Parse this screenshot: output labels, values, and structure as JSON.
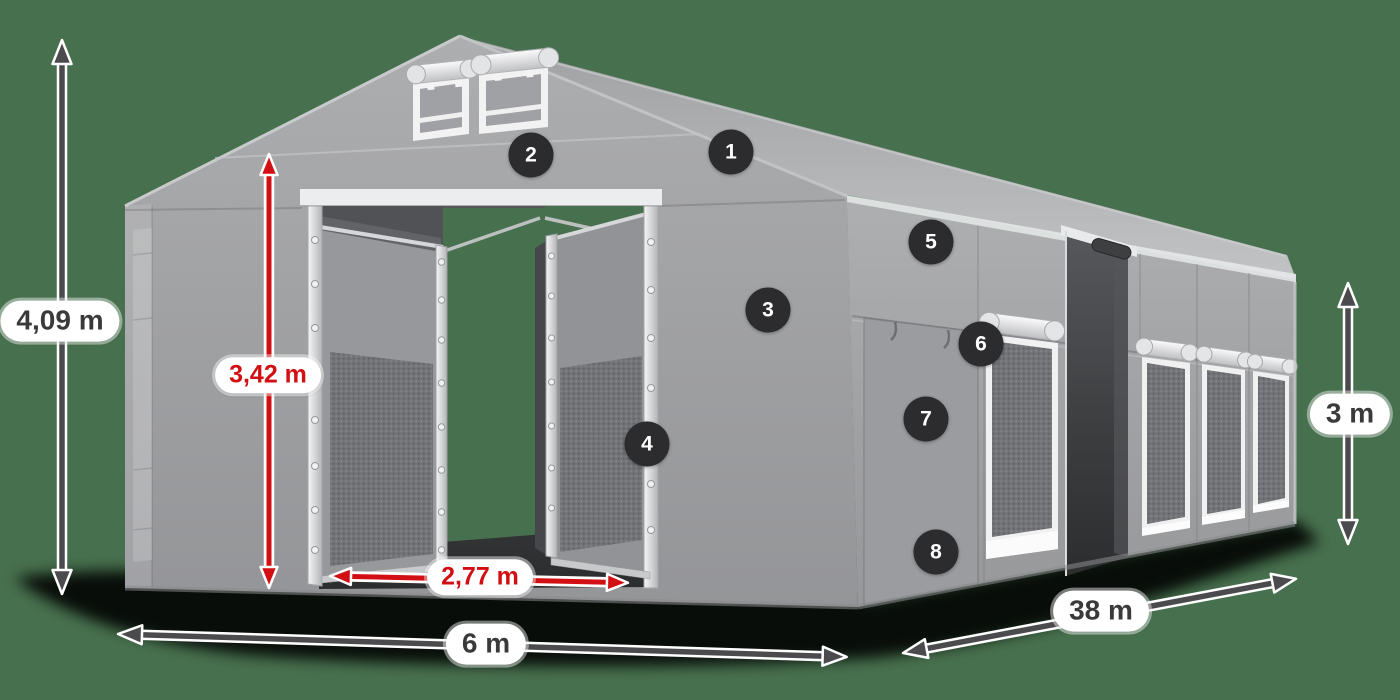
{
  "diagram": {
    "title": "Tent structure dimension diagram",
    "dimensions": {
      "total_height": "4,09 m",
      "entrance_height": "3,42 m",
      "entrance_width": "2,77 m",
      "front_width": "6 m",
      "side_length": "38 m",
      "side_wall_height": "3 m"
    },
    "markers": [
      "1",
      "2",
      "3",
      "4",
      "5",
      "6",
      "7",
      "8"
    ],
    "colors": {
      "background": "#47704E",
      "accent_red": "#D21014",
      "arrow_dark": "#4B4B4D",
      "badge_bg": "#2C2C2E",
      "pill_bg": "#FFFFFF",
      "pill_text": "#3A3A3A"
    }
  }
}
